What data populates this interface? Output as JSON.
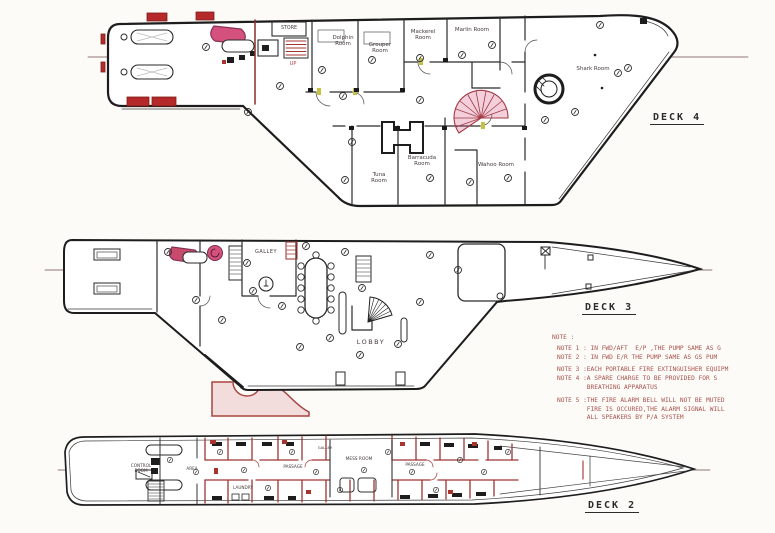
{
  "document": {
    "deck4": {
      "label": "DECK 4",
      "store": "STORE",
      "up": "UP",
      "rooms": {
        "dolphin": "Dolphin Room",
        "grouper": "Grouper Room",
        "mackerel": "Mackerel Room",
        "marlin": "Marlin Room",
        "shark": "Shark Room",
        "tuna": "Tuna Room",
        "barracuda": "Barracuda Room",
        "wahoo": "Wahoo Room"
      }
    },
    "deck3": {
      "label": "DECK 3",
      "galley": "GALLEY",
      "lobby": "LOBBY"
    },
    "deck2": {
      "label": "DECK 2",
      "control_room": "CONTROL ROOM",
      "area": "AREA",
      "laundry": "LAUNDRY",
      "passage_aft": "PASSAGE",
      "galley": "GALLEY",
      "mess_room": "MESS ROOM",
      "passage_fwd": "PASSAGE"
    },
    "notes": {
      "title": "NOTE :",
      "lines": [
        "NOTE 1 : IN FWD/AFT  E/P ,THE PUMP SAME AS G",
        "NOTE 2 : IN FWD E/R THE PUMP SAME AS GS PUM",
        "NOTE 3 :EACH PORTABLE FIRE EXTINGUISHER EQUIPM",
        "NOTE 4 :A SPARE CHARGE TO BE PROVIDED FOR S",
        "        BREATHING APPARATUS",
        "NOTE 5 :THE FIRE ALARM BELL WILL NOT BE MUTED",
        "        FIRE IS OCCURED,THE ALARM SIGNAL WILL",
        "        ALL SPEAKERS BY P/A SYSTEM"
      ]
    },
    "colors": {
      "ink": "#252525",
      "fire_red": "#a83430",
      "raft_red": "#b5292a",
      "pink": "#d4517e",
      "note_text": "#a8524c",
      "threshold_yellow": "#c5c243"
    }
  }
}
